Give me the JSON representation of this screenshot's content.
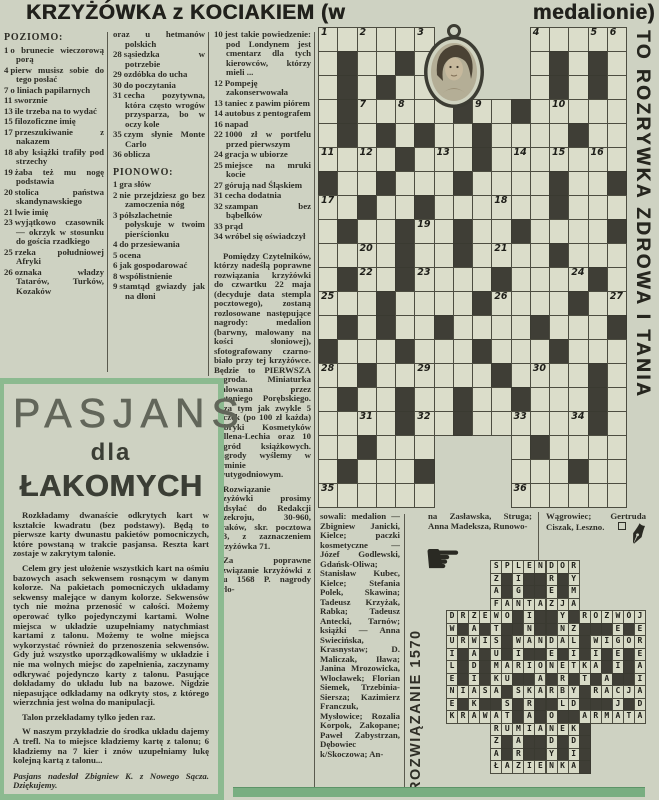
{
  "colors": {
    "paper": "#ced2c2",
    "ink": "#2c2c26",
    "black_cell": "#3f3e36",
    "white_cell": "#dbddca",
    "accent_green": "#8cba90",
    "band_green": "#79ae81"
  },
  "header": {
    "title_left": "KRZYŻÓWKA z KOCIAKIEM (w",
    "title_right": "medalionie)"
  },
  "side_banner": "TO ROZRYWKA ZDROWA I TANIA",
  "icons": {
    "hand": "☛",
    "quill": "✒",
    "medallion": "portrait-locket",
    "end_marker": "□"
  },
  "crossword": {
    "grid": {
      "cols": 16,
      "rows_count": 20,
      "rows": [
        "......     .....",
        ".#..#.     .#.#.",
        ".#.#..     .#.#.",
        ".#.....#..#.....",
        ".#.#.#..#....#..",
        "....#...#.......",
        "#..#...#....#..#",
        "..#..#......#...",
        ".#..#..#..#....#",
        "....#..#....#...",
        ".#..#....#....#.",
        "...#....#....#..",
        ".#.#..#....#...#",
        "#...#...#...#...",
        "..#......#....#.",
        ".#..#..#..#...#.",
        "....#..#......#.",
        "..#...    .#....",
        ".#...#    ...#..",
        "......    ......"
      ],
      "numbers": [
        [
          1,
          1,
          1
        ],
        [
          2,
          1,
          3
        ],
        [
          3,
          1,
          6
        ],
        [
          4,
          1,
          12
        ],
        [
          5,
          1,
          15
        ],
        [
          6,
          1,
          16
        ],
        [
          7,
          4,
          3
        ],
        [
          8,
          4,
          5
        ],
        [
          9,
          4,
          9
        ],
        [
          10,
          4,
          13
        ],
        [
          11,
          6,
          1
        ],
        [
          12,
          6,
          3
        ],
        [
          13,
          6,
          7
        ],
        [
          14,
          6,
          11
        ],
        [
          15,
          6,
          13
        ],
        [
          16,
          6,
          15
        ],
        [
          17,
          8,
          1
        ],
        [
          18,
          8,
          10
        ],
        [
          19,
          9,
          6
        ],
        [
          20,
          10,
          3
        ],
        [
          21,
          10,
          10
        ],
        [
          22,
          11,
          3
        ],
        [
          23,
          11,
          6
        ],
        [
          24,
          11,
          14
        ],
        [
          25,
          12,
          1
        ],
        [
          26,
          12,
          10
        ],
        [
          27,
          12,
          16
        ],
        [
          28,
          15,
          1
        ],
        [
          29,
          15,
          6
        ],
        [
          30,
          15,
          12
        ],
        [
          31,
          17,
          3
        ],
        [
          32,
          17,
          6
        ],
        [
          33,
          17,
          11
        ],
        [
          34,
          17,
          14
        ],
        [
          35,
          20,
          1
        ],
        [
          36,
          20,
          11
        ]
      ]
    }
  },
  "clues": {
    "poziomo_label": "POZIOMO:",
    "pionowo_label": "PIONOWO:",
    "col1": [
      {
        "n": "1",
        "t": "o brunecie wieczorową porą"
      },
      {
        "n": "4",
        "t": "pierw musisz sobie do tego posłać"
      },
      {
        "n": "7",
        "t": "o liniach papilarnych"
      },
      {
        "n": "11",
        "t": "sworznie"
      },
      {
        "n": "13",
        "t": "ile trzeba na to wydać"
      },
      {
        "n": "15",
        "t": "filozoficzne imię"
      },
      {
        "n": "17",
        "t": "przeszukiwanie z nakazem"
      },
      {
        "n": "18",
        "t": "aby książki trafiły pod strzechy"
      },
      {
        "n": "19",
        "t": "żaba też mu nogę podstawia"
      },
      {
        "n": "20",
        "t": "stolica państwa skandynawskiego"
      },
      {
        "n": "21",
        "t": "lwie imię"
      },
      {
        "n": "23",
        "t": "wyjątkowo czasownik — okrzyk w stosunku do gościa rzadkiego"
      },
      {
        "n": "25",
        "t": "rzeka południowej Afryki"
      },
      {
        "n": "26",
        "t": "oznaka władzy Tatarów, Turków, Kozaków"
      }
    ],
    "col2_cont": [
      {
        "n": "",
        "t": "oraz u hetmanów polskich"
      },
      {
        "n": "28",
        "t": "sąsiedzka w potrzebie"
      },
      {
        "n": "29",
        "t": "ozdóbka do ucha"
      },
      {
        "n": "30",
        "t": "do poczytania"
      },
      {
        "n": "31",
        "t": "cecha pozytywna, która często wrogów przysparza, bo w oczy kole"
      },
      {
        "n": "35",
        "t": "czym słynie Monte Carlo"
      },
      {
        "n": "36",
        "t": "oblicza"
      }
    ],
    "col2_pionowo": [
      {
        "n": "1",
        "t": "gra słów"
      },
      {
        "n": "2",
        "t": "nie przejdziesz go bez zamoczenia nóg"
      },
      {
        "n": "3",
        "t": "półszlachetnie połyskuje w twoim pierścionku"
      },
      {
        "n": "4",
        "t": "do przesiewania"
      },
      {
        "n": "5",
        "t": "ocena"
      },
      {
        "n": "6",
        "t": "jak gospodarować"
      },
      {
        "n": "8",
        "t": "współistnienie"
      },
      {
        "n": "9",
        "t": "stamtąd gwiazdy jak na dłoni"
      }
    ],
    "col3": [
      {
        "n": "10",
        "t": "jest takie powiedzenie: pod Londynem jest cmentarz dla tych kierowców, którzy mieli ..."
      },
      {
        "n": "12",
        "t": "Pompeję zakonserwowała"
      },
      {
        "n": "13",
        "t": "taniec z pawim piórem"
      },
      {
        "n": "14",
        "t": "autobus z pentografem"
      },
      {
        "n": "16",
        "t": "napad"
      },
      {
        "n": "22",
        "t": "1000 zł w portfelu przed pierwszym"
      },
      {
        "n": "24",
        "t": "gracja w ubiorze"
      },
      {
        "n": "25",
        "t": "miejsce na mruki kocie"
      },
      {
        "n": "27",
        "t": "górują nad Śląskiem"
      },
      {
        "n": "31",
        "t": "cecha dodatnia"
      },
      {
        "n": "32",
        "t": "szampan bez bąbelków"
      },
      {
        "n": "33",
        "t": "prąd"
      },
      {
        "n": "34",
        "t": "wróbel się oświadczył"
      }
    ]
  },
  "prize_text": [
    "Pomiędzy Czytelników, którzy nadeślą poprawne rozwiązania krzyżówki do czwartku 22 maja (decyduje data stempla pocztowego), zostaną rozlosowane następujące nagrody: medalion (barwny, malowany na kości słoniowej), sfotografowany czarno-biało przy tej krzyżówce. Będzie to PIERWSZA nagroda. Miniaturka malowana przez Antoniego Porębskiego. Poza tym jak zwykle 5 paczek (po 100 zł każda) Fabryki Kosmetyków Pollena-Lechia oraz 10 nagród książkowych. Nagrody wyślemy w terminie dwutygodniowym.",
    "Rozwiązanie krzyżówki prosimy nadsyłać do Redakcji Przekroju, 30-960, Kraków, skr. pocztowa 533, z zaznaczeniem Krzyżówka 71.",
    "Za poprawne rozwiązanie krzyżówki z nru 1568 P. nagrody wylo-"
  ],
  "winners_col1": "sowali: medalion — Zbigniew Janicki, Kielce; paczki kosmetyczne — Józef Godlewski, Gdańsk-Oliwa; Stanisław Kubec, Kielce; Stefania Polek, Skawina; Tadeusz Krzyżak, Rabka; Tadeusz Antecki, Tarnów; książki — Anna Swiecińska, Krasnystaw; D. Maliczak, Iława; Janina Mrozowicka, Włocławek; Florian Siemek, Trzebinia-Siersza; Kazimierz Franczuk, Mysłowice; Rozalia Korpok, Zakopane; Paweł Zabystrzan, Dębowiec k/Skoczowa; An-",
  "winners_col2": "na Zasławska, Struga; Anna Madeksza, Runowo-",
  "winners_col3": "Wągrowiec; Gertruda Ciszak, Leszno.",
  "solution": {
    "label": "ROZWIĄZANIE 1570",
    "rows": [
      "    SPLENDOR      ",
      "    Z#I##R#Y      ",
      "    A#G##E#M      ",
      "    FANTAZJA      ",
      "DRZEWO#I##Y#ROZWÓJ",
      "W#A#T##N##NZ###E#E",
      "URWIS#WANDAL#WIGOR",
      "I#A#U#I##E#I#I#E#E",
      "L#D#MARIONETKA#I#A",
      "E#I#KU##A#R#T#A##I",
      "NIASA#SKARBY#RACJA",
      "E#K##S#R##LD###J#D",
      "KRAWAT#A#O##ARMATA",
      "    RUMIANEK#     ",
      "    Z#A##D#D#     ",
      "    A#R##Y#I#     ",
      "    ŁAZIENKA#     "
    ]
  },
  "pasjans": {
    "title": "PASJANS",
    "subtitle_small": "dla",
    "subtitle_big": "ŁAKOMYCH",
    "paragraphs": [
      "Rozkładamy dwanaście odkrytych kart w kształcie kwadratu (bez podstawy). Będą to pierwsze karty dwunastu pakietów pomocniczych, które powstaną w trakcie pasjansa. Reszta kart zostaje w zakrytym talonie.",
      "Celem gry jest ułożenie wszystkich kart na ośmiu bazowych asach sekwensem rosnącym w danym kolorze. Na pakietach pomocniczych układamy sekwensy malejące w danym kolorze. Sekwensów tych nie można przenosić w całości. Możemy operować tylko pojedynczymi kartami. Wolne miejsca w układzie uzupełniamy natychmiast kartami z talonu. Możemy te wolne miejsca wykorzystać również do przenoszenia sekwensów. Gdy już wszystko uporządkowaliśmy w układzie i nie ma wolnych miejsc do zapełnienia, zaczynamy odkrywać pojedynczo karty z talonu. Pasujące dokładamy do układu lub na bazowe. Nigdzie niepasujące odkładamy na odkryty stos, z którego wierzchnia jest wolna do manipulacji.",
      "Talon przekładamy tylko jeden raz.",
      "W naszym przykładzie do środka układu dajemy A trefl. Na to miejsce kładziemy kartę z talonu; 6 kładziemy na 7 kier i znów uzupełniamy lukę kolejną kartą z talonu..."
    ],
    "credit": "Pasjans nadesłał Zbigniew K. z Nowego Sącza. Dziękujemy."
  }
}
